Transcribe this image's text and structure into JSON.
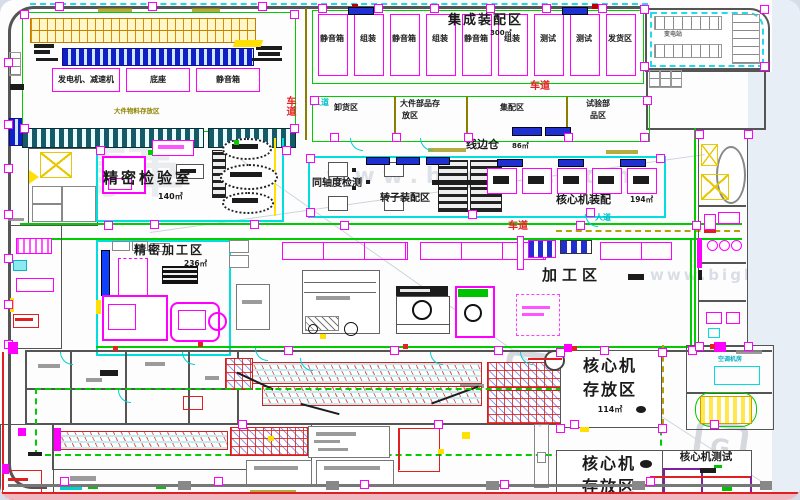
{
  "zones": {
    "integrated_assembly": {
      "title": "集成装配区",
      "area": "300㎡",
      "bays": [
        "静音箱",
        "组装",
        "静音箱",
        "组装",
        "静音箱",
        "组装",
        "测试",
        "测试",
        "发货区"
      ]
    },
    "generator_room": {
      "labels": {
        "a": "发电机、减速机",
        "b": "底座",
        "c": "静音箱"
      },
      "storage_note": "大件物料存放区"
    },
    "substation": {
      "label": "变电站"
    },
    "logistics_strip": {
      "unloading": "卸货区",
      "large_parts_l1": "大件部品存",
      "large_parts_l2": "放区",
      "kitting": "集配区",
      "test_parts_l1": "试验部",
      "test_parts_l2": "品区",
      "line_side": "线边仓",
      "line_side_area": "86㎡"
    },
    "inspection_room": {
      "title": "精密检验室",
      "area": "140㎡"
    },
    "assembly_mid": {
      "coaxial": "同轴度检测",
      "rotor": "转子装配区",
      "core": "核心机装配",
      "core_area": "194㎡"
    },
    "precision_machining": {
      "title": "精密加工区",
      "area": "236㎡"
    },
    "machining": {
      "title": "加工区"
    },
    "core_storage_a": {
      "l1": "核心机",
      "l2": "存放区",
      "area": "114㎡"
    },
    "core_storage_b": {
      "l1": "核心机",
      "l2": "存放区"
    },
    "core_test": {
      "title": "核心机测试"
    },
    "hvac": {
      "label": "空调机房"
    },
    "paths": {
      "lane": "车道",
      "walkway": "人道"
    }
  },
  "watermark": {
    "logo": "G",
    "brand": "博革",
    "url": "www.biglss.com"
  }
}
